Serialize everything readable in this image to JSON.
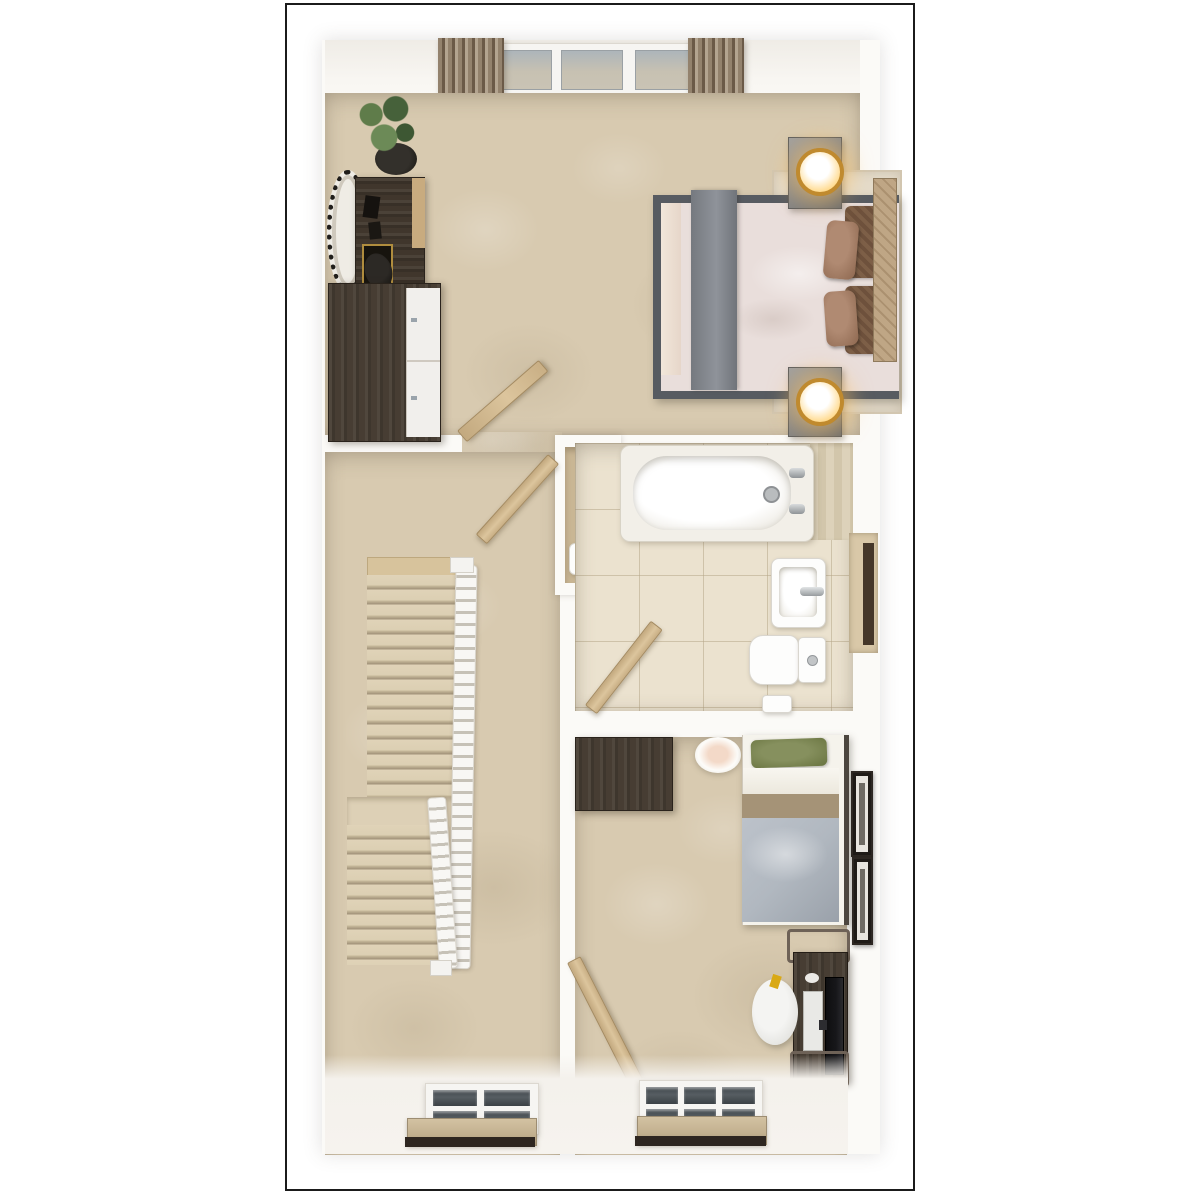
{
  "scene": {
    "type": "3d-floor-plan-top-down-render",
    "title": "",
    "visible_text": "none",
    "rooms": [
      {
        "name": "master-bedroom",
        "position": "top",
        "flooring": "beige carpet",
        "furniture": [
          "double-bed",
          "gray-bed-runner",
          "brown-pillows",
          "tan-headboard",
          "area-rug",
          "nightstand-top",
          "nightstand-bottom",
          "gold-table-lamp-top",
          "gold-table-lamp-bottom",
          "desk",
          "desk-chair",
          "round-woven-mirror",
          "wardrobe-dark-with-white-doors",
          "potted-plant",
          "curtain-left",
          "curtain-right",
          "triple-window",
          "open-door"
        ]
      },
      {
        "name": "landing",
        "position": "middle-left",
        "flooring": "beige carpet",
        "furniture": [
          "staircase-upper-flight",
          "staircase-half-landing",
          "staircase-lower-flight",
          "white-balustrade-long",
          "white-balustrade-short",
          "window-with-blind"
        ]
      },
      {
        "name": "airing-cupboard",
        "position": "middle-center",
        "flooring": "tan",
        "furniture": [
          "boiler-unit",
          "open-door"
        ]
      },
      {
        "name": "bathroom",
        "position": "middle-right",
        "flooring": "cream tiles",
        "furniture": [
          "bathtub",
          "bath-taps",
          "basin-with-tap",
          "toilet",
          "bath-mat",
          "towel-niche",
          "open-door"
        ]
      },
      {
        "name": "bedroom-2",
        "position": "bottom-right",
        "flooring": "beige carpet",
        "furniture": [
          "single-bed",
          "green-pillow",
          "gray-duvet",
          "wardrobe-dark",
          "pendant-lamp",
          "computer-desk",
          "monitor",
          "keyboard",
          "mouse",
          "desk-chair",
          "beanbag",
          "picture-frame-upper",
          "picture-frame-lower",
          "window-with-blind",
          "open-door"
        ]
      }
    ]
  },
  "palette": {
    "frame_border": "#1b1b1b",
    "wall_white": "#fbfaf7",
    "carpet": "#d8cab0",
    "tile": "#ebe2cf",
    "wood_dark": "#40362c",
    "door_wood": "#cfb68f",
    "bed_frame": "#575b61",
    "duvet": "#e9dedb",
    "runner": "#82868c",
    "pillow_brown": "#a17a5f",
    "pillow_dark": "#6e513c",
    "headboard": "#bfa685",
    "green_pillow": "#76804f",
    "duvet_gray": "#b1b8c0",
    "blanket_tan": "#a59377",
    "lamp_gold": "#c08a2e",
    "lamp_glow": "#ffd98a",
    "curtain_dark": "#6b5a48",
    "curtain_mid": "#93826d",
    "curtain_light": "#b3a490",
    "pane": "#adb5ba",
    "pane_warm": "#c9c3b4",
    "blind": "#c2b08f",
    "sill_dark": "#2e2620",
    "plant_green": "#5d7a49",
    "monitor_black": "#17171a"
  }
}
